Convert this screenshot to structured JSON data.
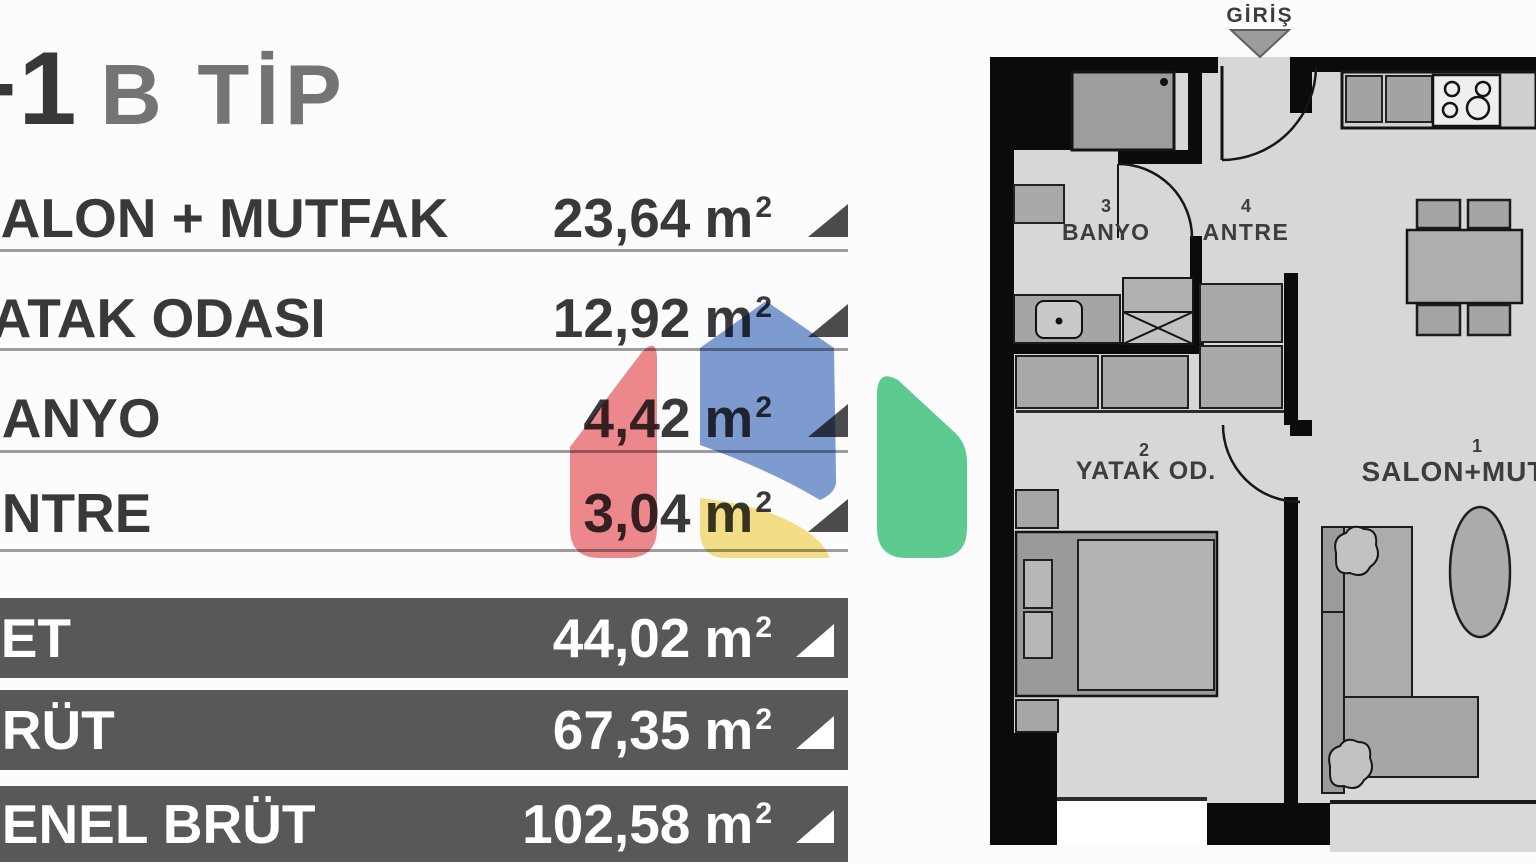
{
  "title": {
    "dark": "1+1",
    "light": "B TİP"
  },
  "unit": {
    "base": "m",
    "exp": "2"
  },
  "rooms": [
    {
      "label": "SALON + MUTFAK",
      "area": "23,64"
    },
    {
      "label": "YATAK ODASI",
      "area": "12,92"
    },
    {
      "label": "BANYO",
      "area": "4,42"
    },
    {
      "label": "ANTRE",
      "area": "3,04"
    }
  ],
  "totals": [
    {
      "label": "NET",
      "area": "44,02"
    },
    {
      "label": "BRÜT",
      "area": "67,35"
    },
    {
      "label": "GENEL BRÜT",
      "area": "102,58"
    }
  ],
  "plan": {
    "entrance": "GİRİŞ",
    "rooms": [
      {
        "no": "1",
        "name": "SALON+MUTFAK"
      },
      {
        "no": "2",
        "name": "YATAK OD."
      },
      {
        "no": "3",
        "name": "BANYO"
      },
      {
        "no": "4",
        "name": "ANTRE"
      }
    ]
  },
  "colors": {
    "bar_background": "#58585b",
    "logo_blue": "#7f9dd3",
    "logo_red": "#ef8a8d",
    "logo_yellow": "#f6e189",
    "logo_green": "#5ecd92"
  }
}
